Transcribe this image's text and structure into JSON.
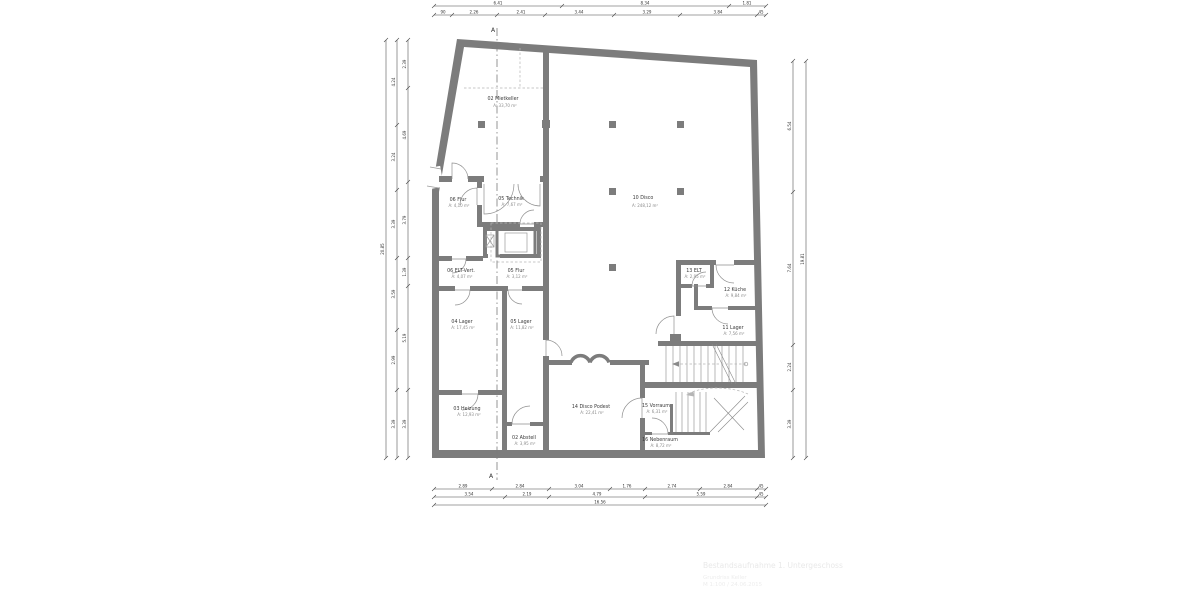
{
  "drawing": {
    "markers": {
      "section_top": "A",
      "section_bottom": "A"
    },
    "rooms": [
      {
        "name": "02 Mietkeller",
        "area": "A: 33,70 m²"
      },
      {
        "name": "06 Flur",
        "area": "A: 4,10 m²"
      },
      {
        "name": "05 Technik",
        "area": "A: 7,67 m²"
      },
      {
        "name": "06 ELT-Vert.",
        "area": "A: 4,07 m²"
      },
      {
        "name": "05 Flur",
        "area": "A: 3,12 m²"
      },
      {
        "name": "04 Lager",
        "area": "A: 17,45 m²"
      },
      {
        "name": "05 Lager",
        "area": "A: 11,82 m²"
      },
      {
        "name": "03 Heizung",
        "area": "A: 12,93 m²"
      },
      {
        "name": "02 Abstell",
        "area": "A: 3,95 m²"
      },
      {
        "name": "14 Disco Podest",
        "area": "A: 22,41 m²"
      },
      {
        "name": "15 Vorraum",
        "area": "A: 6,31 m²"
      },
      {
        "name": "16 Nebenraum",
        "area": "A: 8,72 m²"
      },
      {
        "name": "13 ELT",
        "area": "A: 2,95 m²"
      },
      {
        "name": "12 Küche",
        "area": "A: 9,84 m²"
      },
      {
        "name": "11 Lager",
        "area": "A: 7,56 m²"
      },
      {
        "name": "10 Disco",
        "area": "A: 248,12 m²"
      }
    ],
    "dims": {
      "top1": [
        "6.41",
        "8.34",
        "1.81"
      ],
      "top2": [
        "90",
        "2.26",
        "2.41",
        "3.44",
        "3.29",
        "3.84",
        "45"
      ],
      "bottom1": [
        "2.89",
        "2.84",
        "3.04",
        "1.76",
        "2.74",
        "2.84",
        "45"
      ],
      "bottom2": [
        "3.54",
        "2.19",
        "4.79",
        "5.59",
        "45"
      ],
      "bottom3": [
        "16.56"
      ],
      "left_inner": [
        "2.39",
        "4.69",
        "3.79",
        "1.39",
        "5.19",
        "3.39"
      ],
      "left_mid": [
        "4.24",
        "3.24",
        "3.39",
        "3.59",
        "2.99",
        "3.39"
      ],
      "left_total": [
        "20.85"
      ],
      "right_inner": [
        "6.54",
        "7.64",
        "2.24",
        "3.39"
      ],
      "right_total": [
        "19.81"
      ]
    },
    "watermark": [
      "Bestandsaufnahme 1. Untergeschoss",
      "Grundriss Keller",
      "M 1:100 / 24.06.2015"
    ]
  }
}
